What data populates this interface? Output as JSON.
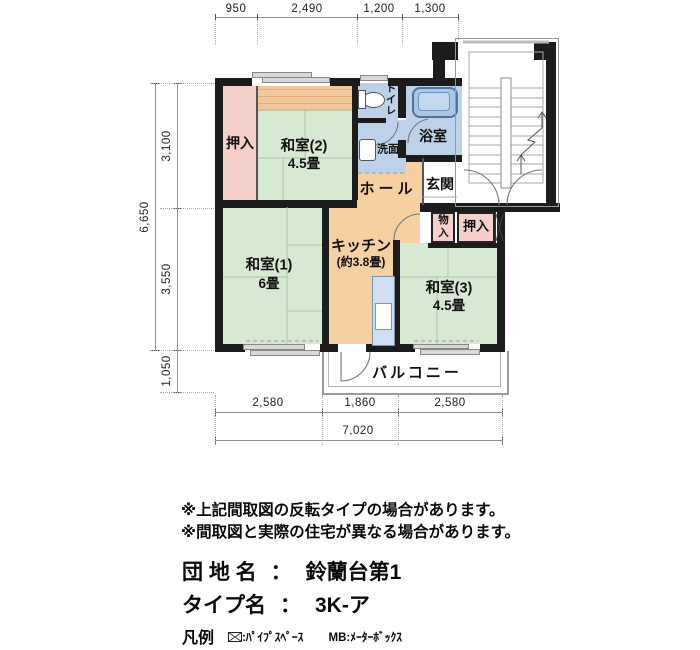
{
  "plan": {
    "rooms": {
      "oshiire_top": "押入",
      "washitsu2_name": "和室(2)",
      "washitsu2_size": "4.5畳",
      "toilet": "トイレ",
      "washroom": "洗面",
      "bathroom": "浴室",
      "hall": "ホール",
      "genkan": "玄関",
      "storage_small": "物入",
      "oshiire_right": "押入",
      "kitchen_name": "キッチン",
      "kitchen_size": "(約3.8畳)",
      "washitsu1_name": "和室(1)",
      "washitsu1_size": "6畳",
      "washitsu3_name": "和室(3)",
      "washitsu3_size": "4.5畳",
      "balcony": "バルコニー"
    },
    "dimensions": {
      "top": [
        "950",
        "2,490",
        "1,200",
        "1,300"
      ],
      "left_segments": [
        "3,100",
        "3,550",
        "1,050"
      ],
      "left_total": "6,650",
      "bottom_segments": [
        "2,580",
        "1,860",
        "2,580"
      ],
      "bottom_total": "7,020"
    }
  },
  "notes": [
    "※上記間取図の反転タイプの場合があります。",
    "※間取図と実際の住宅が異なる場合があります。"
  ],
  "estate": {
    "label": "団 地 名",
    "separator": "：",
    "value": "鈴蘭台第1"
  },
  "type_info": {
    "label": "タイプ名",
    "separator": "：",
    "value": "3K-ア"
  },
  "legend": {
    "title": "凡例",
    "pipe_space_label": ":ﾊﾟｲﾌﾟｽﾍﾟｰｽ",
    "meter_box_label": "MB:ﾒｰﾀｰﾎﾞｯｸｽ"
  },
  "colors": {
    "wall": "#1c1c1c",
    "tatami_green": "#d7e8d3",
    "closet_pink": "#f5cfc9",
    "wood_orange": "#f6cfa2",
    "wet_area_blue": "#bdd2e9",
    "counter_blue": "#cfe0f2",
    "window_gray": "#d8d8d8"
  }
}
